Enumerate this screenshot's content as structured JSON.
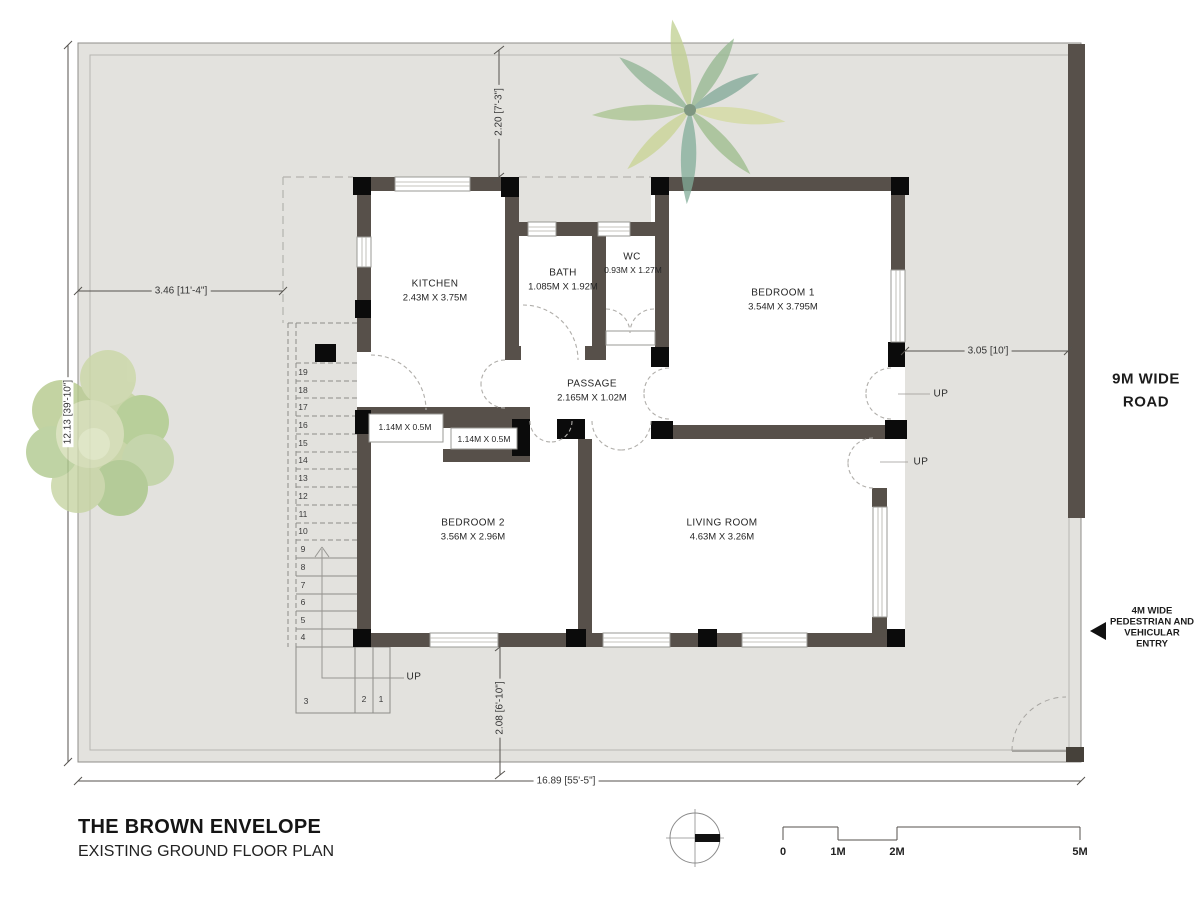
{
  "title_block": {
    "project": "THE BROWN ENVELOPE",
    "drawing": "EXISTING GROUND FLOOR PLAN"
  },
  "rooms": {
    "kitchen": {
      "name": "KITCHEN",
      "size": "2.43M X 3.75M"
    },
    "bath": {
      "name": "BATH",
      "size": "1.085M X 1.92M"
    },
    "wc": {
      "name": "WC",
      "size": "0.93M X 1.27M"
    },
    "bedroom1": {
      "name": "BEDROOM 1",
      "size": "3.54M X 3.795M"
    },
    "passage": {
      "name": "PASSAGE",
      "size": "2.165M X 1.02M"
    },
    "bedroom2": {
      "name": "BEDROOM 2",
      "size": "3.56M X 2.96M"
    },
    "living": {
      "name": "LIVING ROOM",
      "size": "4.63M X 3.26M"
    }
  },
  "closets": {
    "left": "1.14M X 0.5M",
    "right": "1.14M X 0.5M"
  },
  "dimensions": {
    "top_setback": "2.20 [7'-3\"]",
    "left_setback": "3.46 [11'-4\"]",
    "site_depth": "12.13 [39'-10\"]",
    "right_setback": "3.05 [10']",
    "bottom_setback": "2.08 [6'-10\"]",
    "site_width": "16.89 [55'-5\"]"
  },
  "labels": {
    "up": "UP",
    "road_line1": "9M WIDE",
    "road_line2": "ROAD",
    "entry_line1": "4M WIDE",
    "entry_line2": "PEDESTRIAN AND",
    "entry_line3": "VEHICULAR",
    "entry_line4": "ENTRY"
  },
  "stairs": {
    "numbers": [
      "19",
      "18",
      "17",
      "16",
      "15",
      "14",
      "13",
      "12",
      "11",
      "10",
      "9",
      "8",
      "7",
      "6",
      "5",
      "4"
    ],
    "winders": [
      "3",
      "2",
      "1"
    ]
  },
  "scale_bar": {
    "t0": "0",
    "t1": "1M",
    "t2": "2M",
    "t5": "5M"
  },
  "colors": {
    "site_fill": "#e3e2de",
    "wall": "#57504a",
    "column": "#0b0b0b",
    "tree_green": "#bfcf9a",
    "palm_green": "#aac394",
    "palm_teal": "#8fb2a6"
  }
}
